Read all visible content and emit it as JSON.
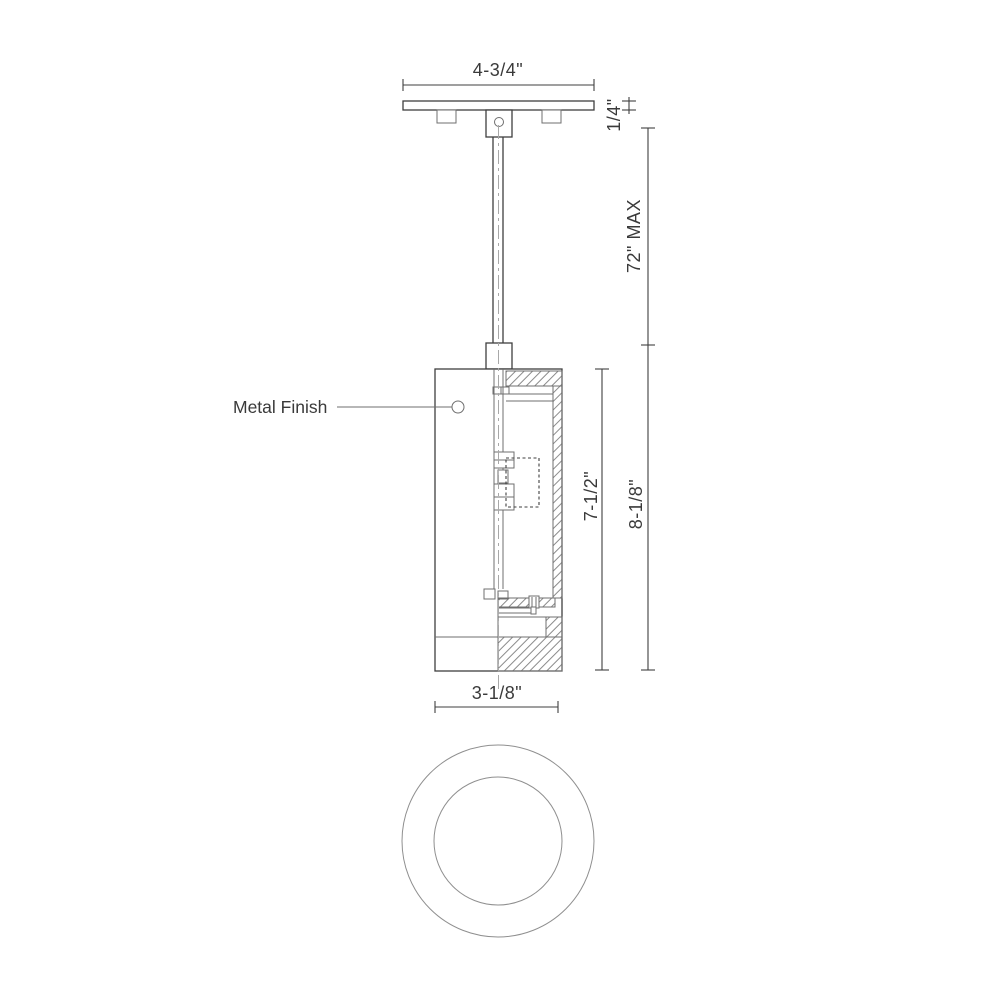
{
  "drawing": {
    "colors": {
      "line": "#3f3f3f",
      "thin": "#6f6f6f",
      "centerline": "#a8a8a8",
      "hatch": "#6f6f6f",
      "text": "#3a3a3a",
      "circle_view": "#8f8f8f",
      "background": "#ffffff"
    },
    "labels": {
      "metal_finish": "Metal Finish"
    },
    "dimensions": {
      "canopy_width": "4-3/4\"",
      "canopy_thickness": "1/4\"",
      "suspension_max": "72\" MAX",
      "body_height": "7-1/2\"",
      "overall_height": "8-1/8\"",
      "body_diameter": "3-1/8\""
    }
  }
}
